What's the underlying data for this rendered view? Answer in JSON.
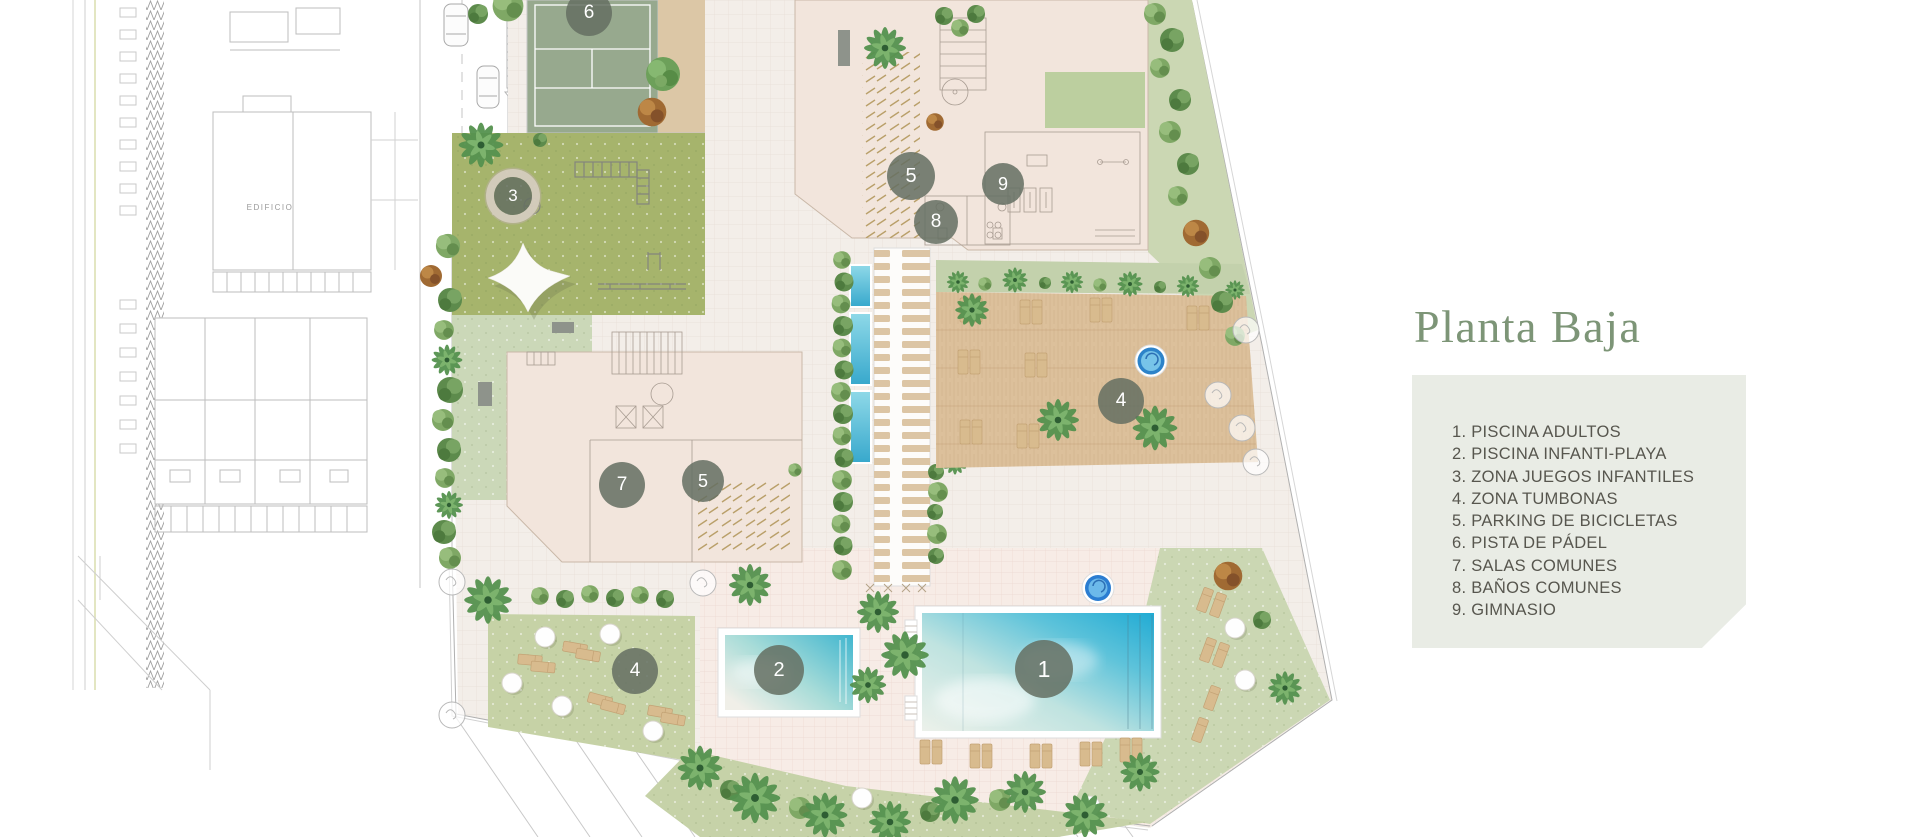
{
  "title": "Planta Baja",
  "legend": {
    "items": [
      "1. PISCINA ADULTOS",
      "2. PISCINA INFANTI-PLAYA",
      "3. ZONA JUEGOS INFANTILES",
      "4. ZONA TUMBONAS",
      "5. PARKING DE BICICLETAS",
      "6. PISTA DE PÁDEL",
      "7. SALAS COMUNES",
      "8. BAÑOS COMUNES",
      "9. GIMNASIO"
    ]
  },
  "map": {
    "edificio_label": "EDIFICIO",
    "markers": [
      {
        "number": "6",
        "legend_label": "PISTA DE PÁDEL"
      },
      {
        "number": "3",
        "legend_label": "ZONA JUEGOS INFANTILES"
      },
      {
        "number": "5",
        "legend_label": "PARKING DE BICICLETAS"
      },
      {
        "number": "8",
        "legend_label": "BAÑOS COMUNES"
      },
      {
        "number": "9",
        "legend_label": "GIMNASIO"
      },
      {
        "number": "7",
        "legend_label": "SALAS COMUNES"
      },
      {
        "number": "5",
        "legend_label": "PARKING DE BICICLETAS"
      },
      {
        "number": "4",
        "legend_label": "ZONA TUMBONAS"
      },
      {
        "number": "4",
        "legend_label": "ZONA TUMBONAS"
      },
      {
        "number": "2",
        "legend_label": "PISCINA INFANTI-PLAYA"
      },
      {
        "number": "1",
        "legend_label": "PISCINA ADULTOS"
      }
    ]
  },
  "colors": {
    "title_green": "#7d9577",
    "legend_bg": "#e9ece5",
    "legend_text": "#57564e",
    "marker_bg": "#646f63",
    "pool_turquoise": "#35b3d8",
    "lawn_green": "#cbd7b3",
    "playground_olive": "#a6b46c",
    "padel_green": "#97a98e",
    "deck_wood": "#dcc09b"
  }
}
